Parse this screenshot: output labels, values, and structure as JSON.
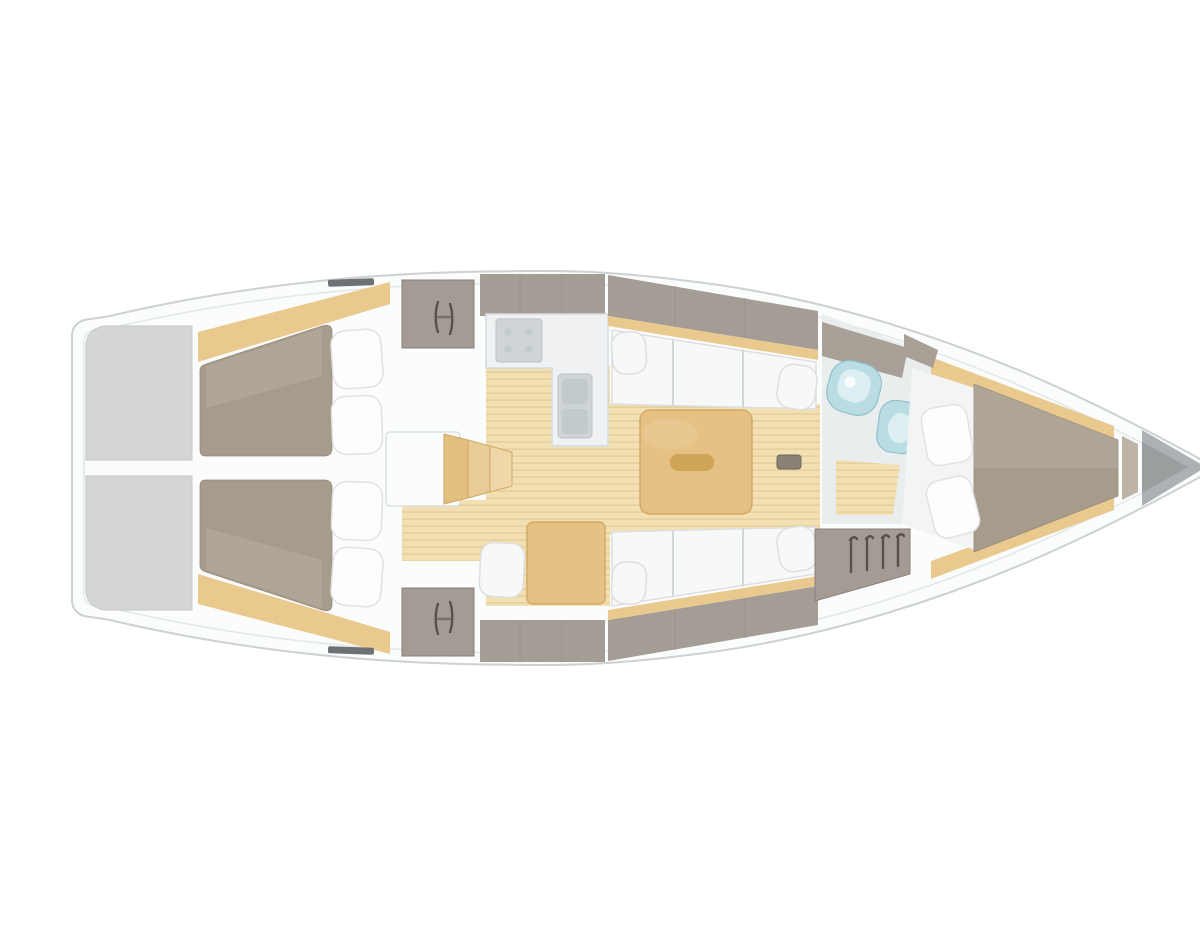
{
  "diagram": {
    "type": "yacht-interior-floorplan",
    "orientation": "bow-right",
    "label": "Sailing yacht interior layout floor plan, top-down view",
    "areas": [
      {
        "id": "transom-lockers",
        "desc": "Stern transom storage lockers"
      },
      {
        "id": "aft-cabin-port",
        "desc": "Aft double cabin, port side, bed with two pillows"
      },
      {
        "id": "aft-cabin-starboard",
        "desc": "Aft double cabin, starboard side, bed with two pillows"
      },
      {
        "id": "companionway-steps",
        "desc": "Companionway entry steps"
      },
      {
        "id": "galley",
        "desc": "L-shaped galley with stove and sink"
      },
      {
        "id": "salon",
        "desc": "Salon with port and starboard settees and centre table"
      },
      {
        "id": "nav-station",
        "desc": "Chart table with seat"
      },
      {
        "id": "head",
        "desc": "Head compartment with washbasin and toilet"
      },
      {
        "id": "hanging-locker",
        "desc": "Hanging locker with four hangers"
      },
      {
        "id": "v-berth",
        "desc": "Forward V-berth cabin with double bed and two pillows"
      },
      {
        "id": "anchor-locker",
        "desc": "Bow anchor locker"
      }
    ],
    "icons": [
      "locker-handle-icon",
      "hanger-icon",
      "stove-burner-icon",
      "sink-icon",
      "toilet-icon",
      "washbasin-icon"
    ]
  },
  "colors": {
    "page_bg": "#ffffff",
    "hull_fill": "#fbfcfc",
    "hull_stroke": "#ccd1d3",
    "deck_line": "#e3e7e8",
    "transom_gray": "#d3d5d7",
    "transom_stroke": "#c4c7c9",
    "bed_taupe": "#a79c8c",
    "bed_stroke": "#968b7b",
    "sheet_white": "#f3f4f4",
    "bed_foot": "#bdb4a7",
    "pillow_white": "#fdfdfd",
    "pillow_stroke": "#e1e3e3",
    "wood_trim": "#eac98f",
    "wood_floor": "#f2e0b2",
    "wood_plank": "#dfc691",
    "table_wood": "#e6c185",
    "table_stroke": "#d3ab67",
    "table_inset": "#d1a558",
    "step_wood_1": "#e2bf7e",
    "step_wood_2": "#e9cb95",
    "step_wood_3": "#f0d7a8",
    "step_stroke": "#cfa968",
    "counter_white": "#eff1f2",
    "counter_stroke": "#d7dbdd",
    "inset_gray": "#ced4d7",
    "inset_stroke": "#bcc2c5",
    "inset_deep": "#c3cacd",
    "band_gray": "#a49d96",
    "band_taupe": "#a89f97",
    "band_seam": "#8f8881",
    "locker_gray": "#a39b94",
    "locker_stroke": "#8a8279",
    "icon_dark": "#57514b",
    "settee_white": "#f7f8f8",
    "settee_stroke": "#dddfe0",
    "settee_seam": "#d2d6d7",
    "fixture_blue": "#b9dde3",
    "fixture_blue_deep": "#8fc2cb",
    "fixture_blue_light": "#ddeff2",
    "head_floor": "#e9edee",
    "floor_hatch": "#8a8177",
    "floor_hatch_stroke": "#6e675d",
    "anchor_gray": "#aeb1b3",
    "anchor_dark": "#8f9395",
    "fitting_dark": "#6d7174"
  }
}
